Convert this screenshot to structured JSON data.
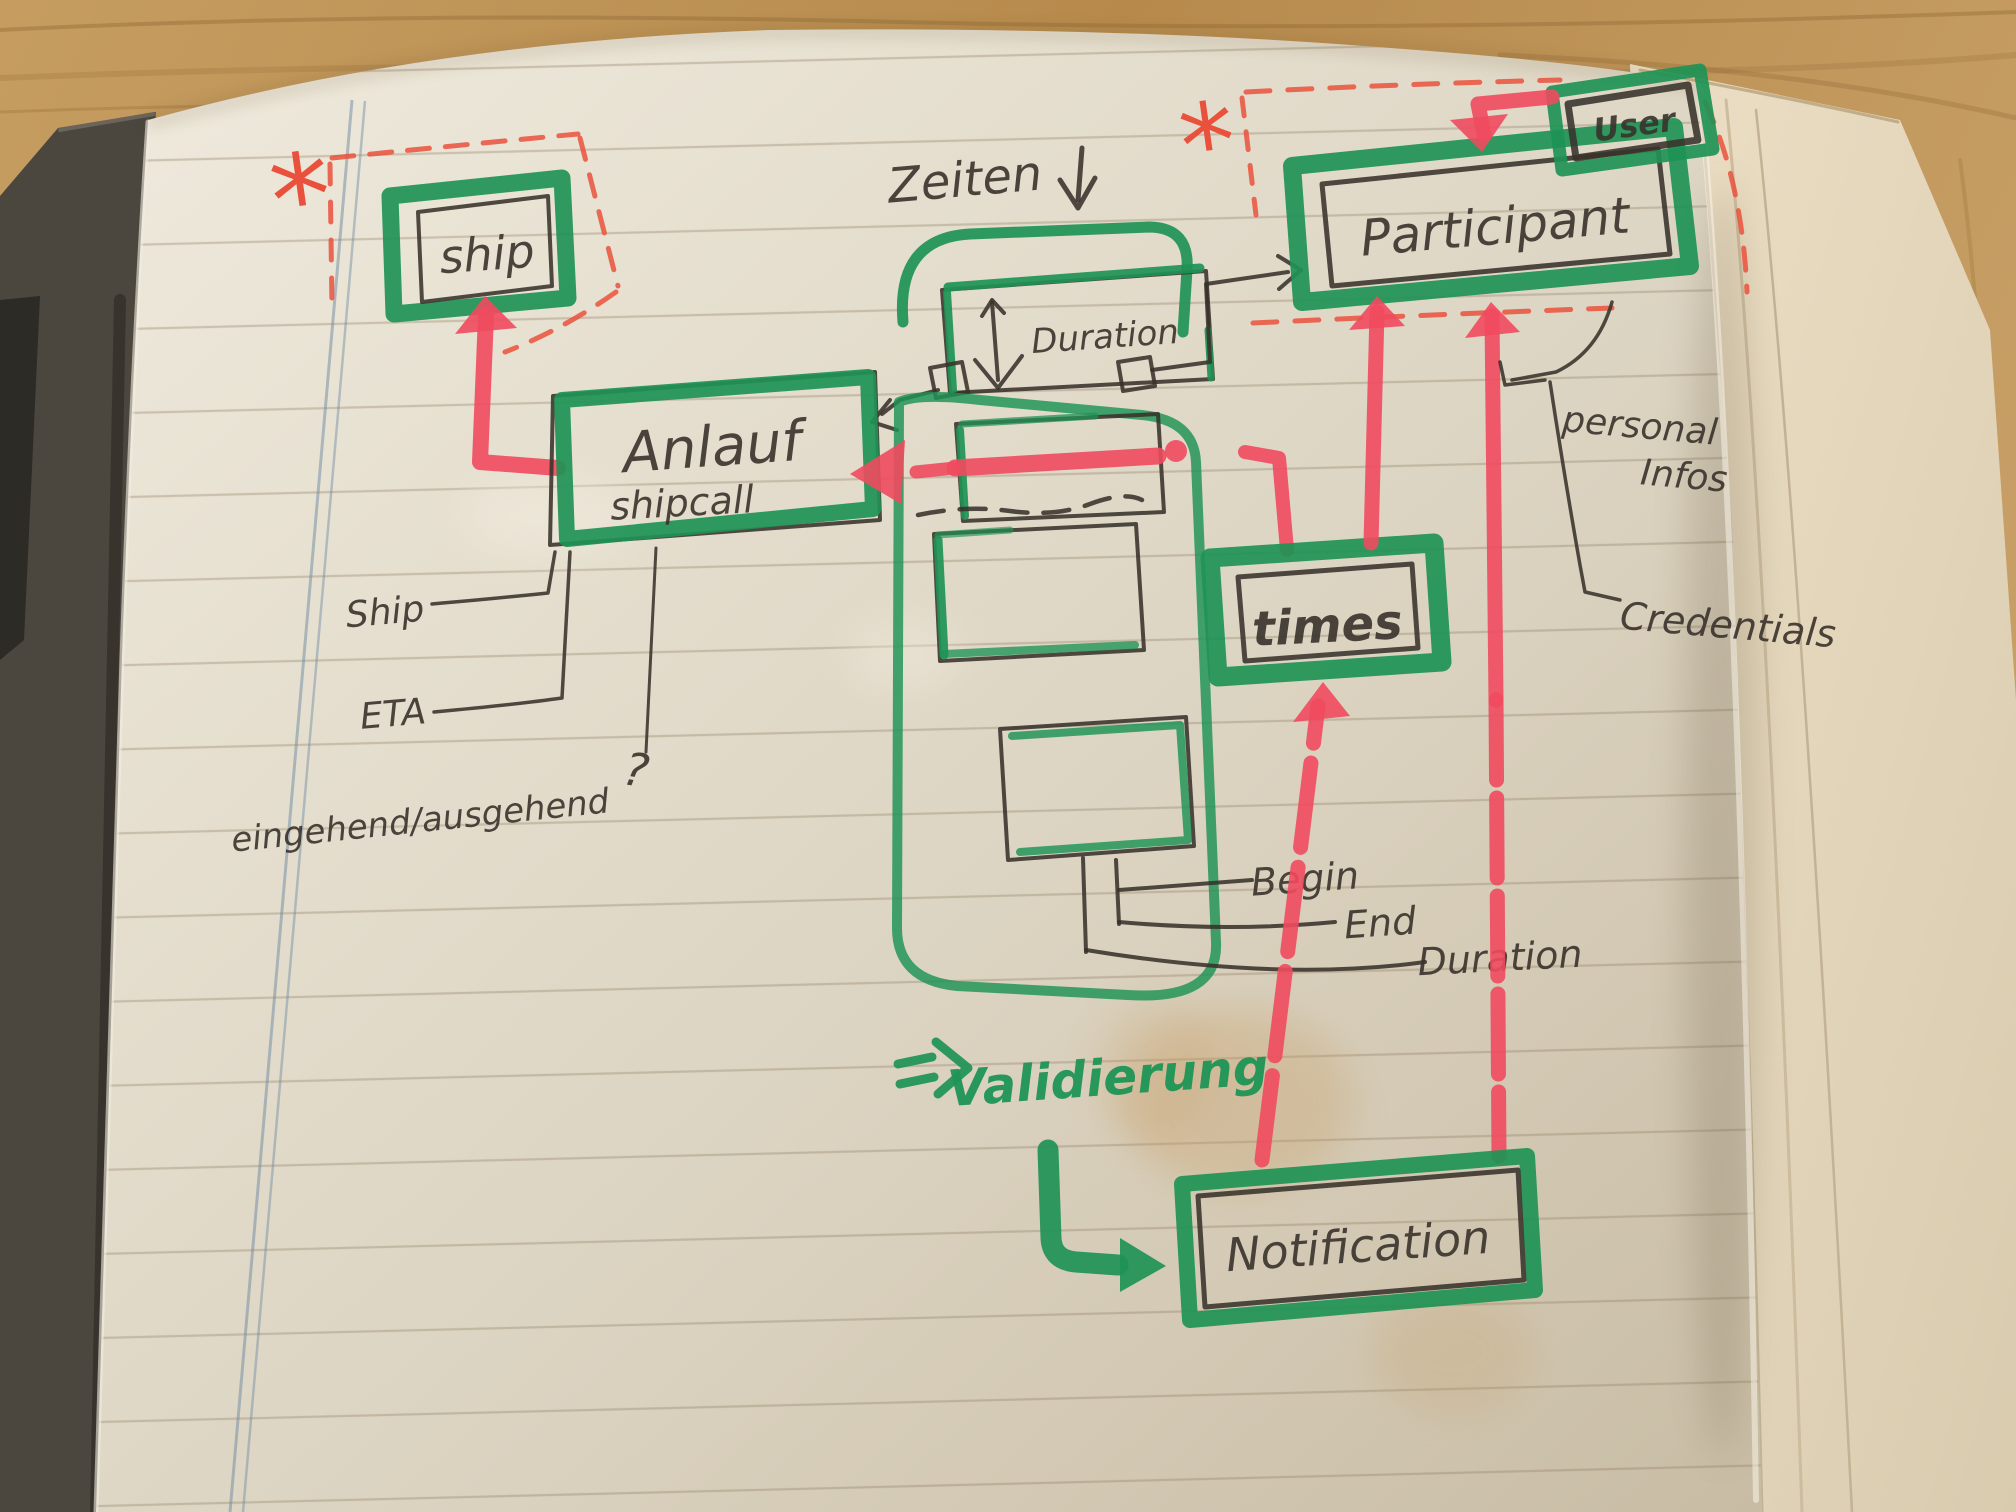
{
  "photo": {
    "entities": {
      "ship": "ship",
      "anlauf": "Anlauf",
      "anlauf_sub": "shipcall",
      "duration_box": "Duration",
      "participant": "Participant",
      "user": "User",
      "times": "times",
      "notification": "Notification"
    },
    "annotations": {
      "zeiten": "Zeiten",
      "ship_attr": "Ship",
      "eta": "ETA",
      "inout": "eingehend/ausgehend",
      "question_mark": "?",
      "begin": "Begin",
      "end": "End",
      "duration": "Duration",
      "personal_line1": "personal",
      "personal_line2": "Infos",
      "credentials": "Credentials",
      "validierung": "Validierung",
      "asterisk": "*"
    },
    "colors": {
      "marker_green": "#1e9355",
      "marker_red": "#ef4a5e",
      "dashed_red": "#ea513c",
      "pen_black": "#38322b",
      "paper": "#e2dbcb",
      "wood": "#bd9254"
    }
  }
}
